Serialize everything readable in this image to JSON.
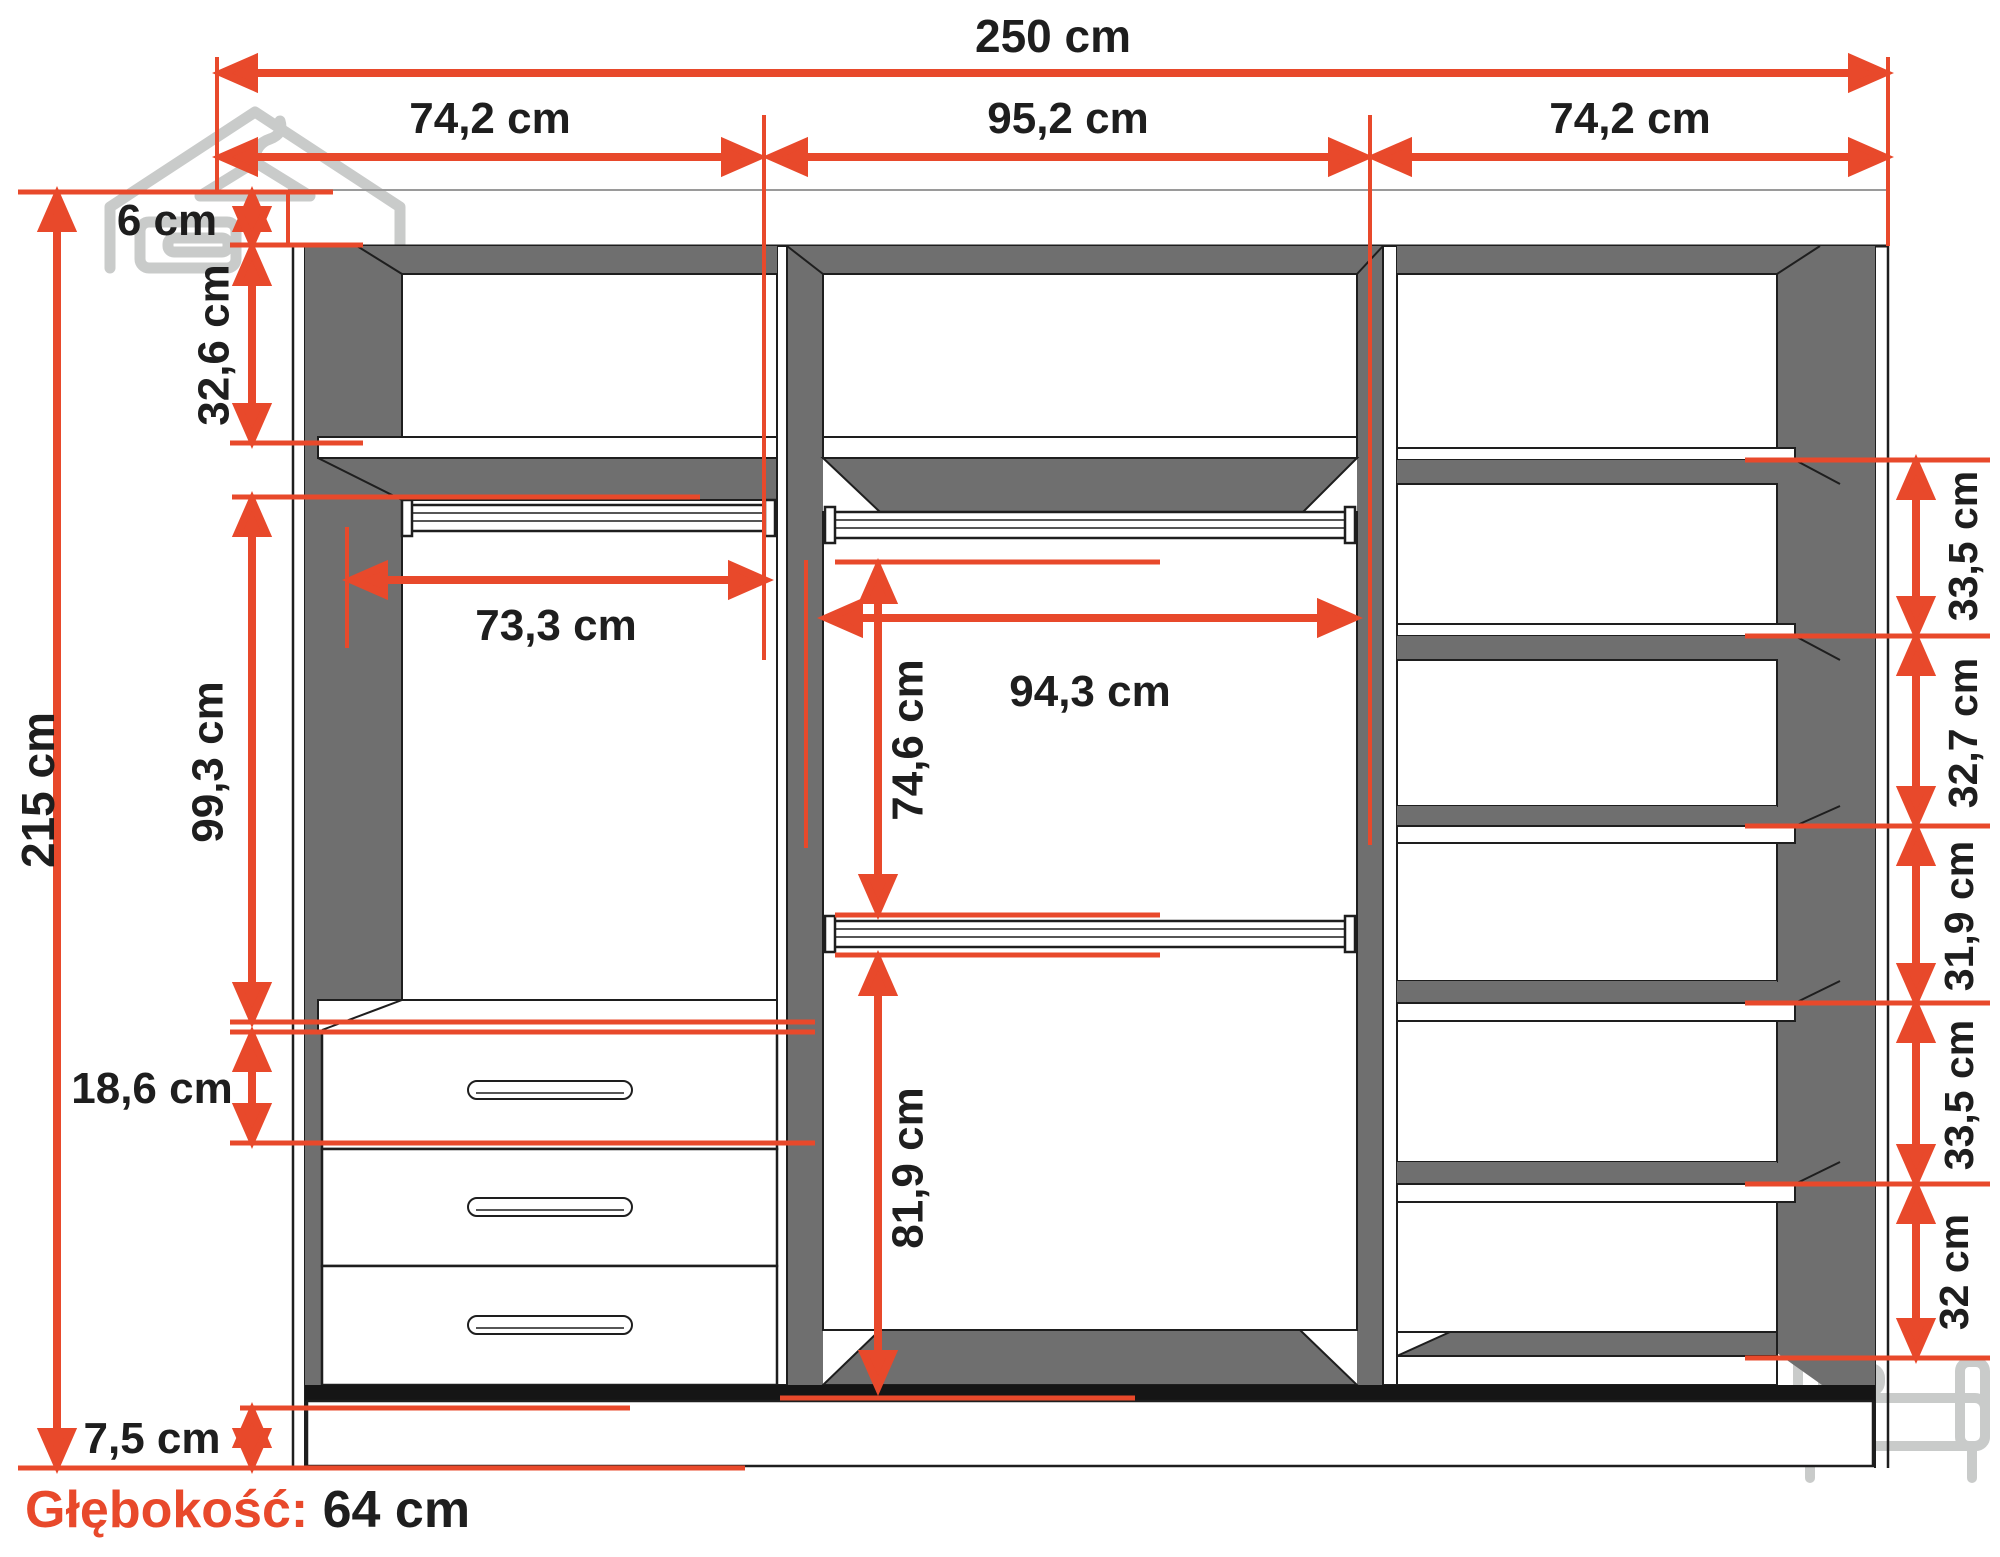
{
  "diagram": {
    "type": "furniture-dimension-diagram",
    "subject": "wardrobe-interior-cross-section",
    "units": "cm"
  },
  "dimensions": {
    "total_width": "250 cm",
    "sections_top": [
      "74,2 cm",
      "95,2 cm",
      "74,2 cm"
    ],
    "left": {
      "top_panel": "6 cm",
      "upper_section": "32,6 cm",
      "total_height": "215 cm",
      "hanging_section": "99,3 cm",
      "drawer_section": "18,6 cm",
      "plinth": "7,5 cm"
    },
    "middle": {
      "left_inner_width": "73,3 cm",
      "inner_width": "94,3 cm",
      "upper_inner_height": "74,6 cm",
      "lower_inner_height": "81,9 cm"
    },
    "right_shelves": [
      "33,5 cm",
      "32,7 cm",
      "31,9 cm",
      "33,5 cm",
      "32 cm"
    ],
    "depth": {
      "label": "Głębokość:",
      "value": "64 cm"
    }
  },
  "icons": {
    "top_left": "wardrobe-hanger-icon",
    "bottom_right": "bed-icon"
  },
  "colors": {
    "accent": "#e8492b",
    "wall_gray": "#6f6f6f",
    "outline": "#1e1e1e",
    "icon_gray": "#c9cbca",
    "background": "#ffffff"
  }
}
